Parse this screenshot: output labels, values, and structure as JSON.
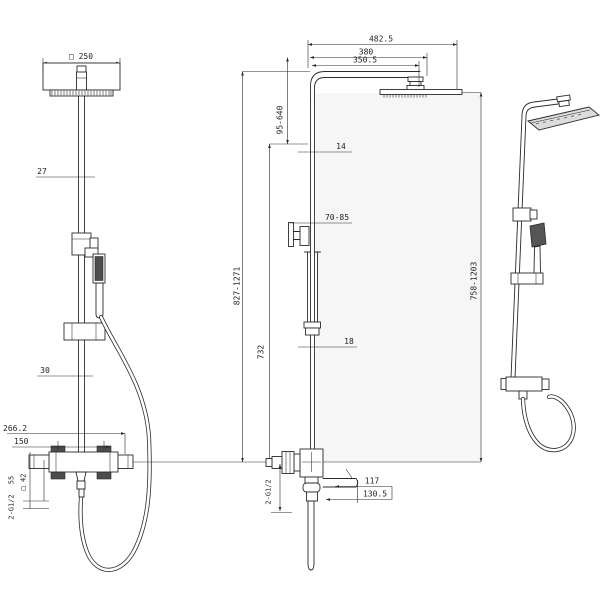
{
  "drawing": {
    "type": "shower-column-technical-drawing",
    "colors": {
      "line": "#2b2b2b",
      "wall_fill": "#f6f6f6",
      "text": "#222222",
      "background": "#ffffff"
    },
    "front": {
      "head_width": "□ 250",
      "pipe_width": "27",
      "slider": "30",
      "overall_width": "266.2",
      "inlet_distance": "150",
      "depth": "55",
      "body_square": "□ 42",
      "inlets": "2-G1/2"
    },
    "side": {
      "reach_total": "482.5",
      "reach_arm": "380",
      "reach_spray": "350.5",
      "head_adjust": "95-640",
      "pipe_dia": "14",
      "bracket_range": "70-85",
      "height_total": "827-1271",
      "tube_fixed": "732",
      "tube_dia": "18",
      "outlets": "2-G1/2",
      "handle_len": "117",
      "handle_reach": "130.5",
      "height_adjust": "758-1203"
    }
  }
}
